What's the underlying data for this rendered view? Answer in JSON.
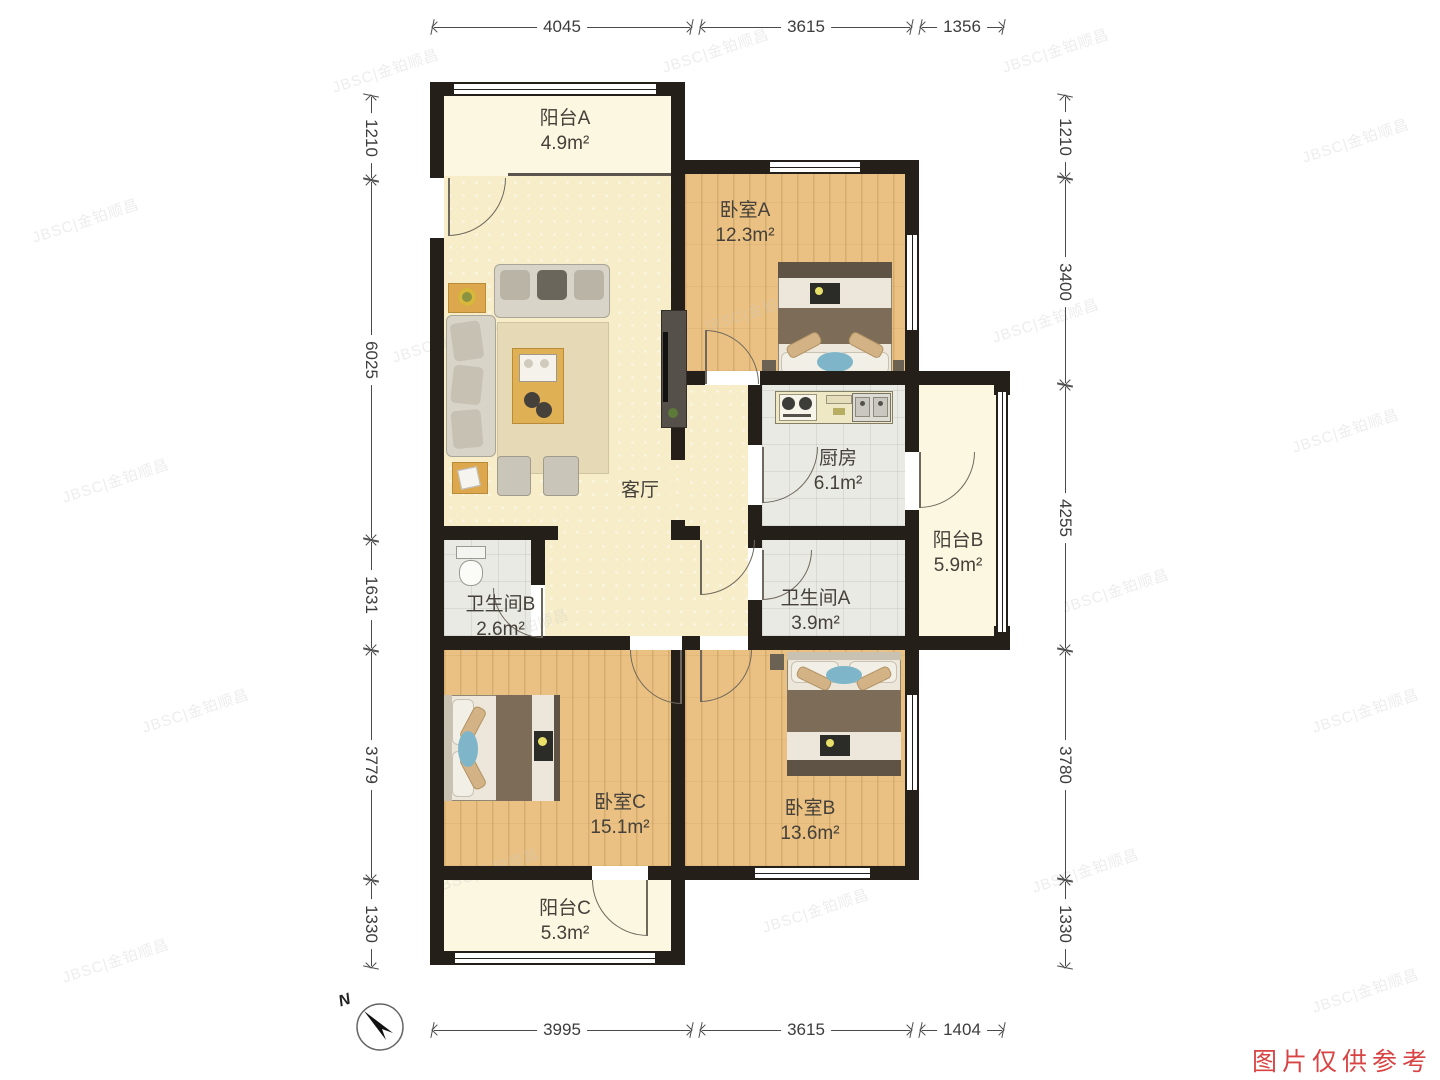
{
  "rooms": {
    "balcony_a": {
      "name": "阳台A",
      "area": "4.9m²"
    },
    "bedroom_a": {
      "name": "卧室A",
      "area": "12.3m²"
    },
    "living_room": {
      "name": "客厅",
      "area": ""
    },
    "kitchen": {
      "name": "厨房",
      "area": "6.1m²"
    },
    "balcony_b": {
      "name": "阳台B",
      "area": "5.9m²"
    },
    "bathroom_b": {
      "name": "卫生间B",
      "area": "2.6m²"
    },
    "bathroom_a": {
      "name": "卫生间A",
      "area": "3.9m²"
    },
    "bedroom_c": {
      "name": "卧室C",
      "area": "15.1m²"
    },
    "bedroom_b": {
      "name": "卧室B",
      "area": "13.6m²"
    },
    "balcony_c": {
      "name": "阳台C",
      "area": "5.3m²"
    }
  },
  "dimensions": {
    "top": [
      "4045",
      "3615",
      "1356"
    ],
    "bottom": [
      "3995",
      "3615",
      "1404"
    ],
    "left": [
      "1210",
      "6025",
      "1631",
      "3779",
      "1330"
    ],
    "right": [
      "1210",
      "3400",
      "4255",
      "3780",
      "1330"
    ]
  },
  "compass": {
    "label": "N"
  },
  "watermark": {
    "text": "JBSC|金铂顺昌"
  },
  "footer": {
    "note": "图片仅供参考"
  },
  "colors": {
    "wall": "#251f19",
    "balcony_floor": "#fbf7e0",
    "living_floor": "#f7eec9",
    "wood_floor": "#eac182",
    "tile_floor": "#eaeae5",
    "note_red": "#d84444"
  }
}
